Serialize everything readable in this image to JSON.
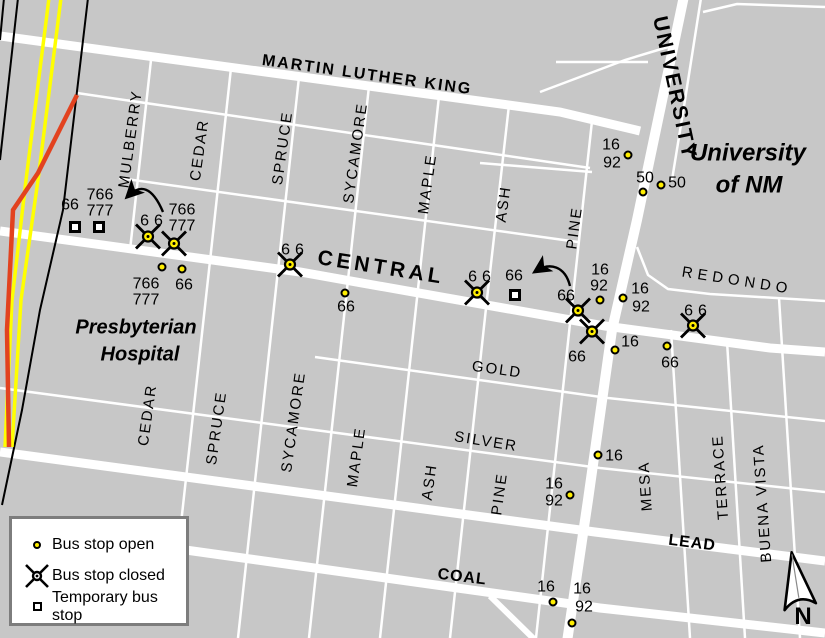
{
  "map": {
    "colors": {
      "background": "#c7c7c7",
      "street": "#ffffff",
      "railroad_yellow": "#ffff00",
      "route_highlight_red": "#e2421f",
      "stop_yellow": "#ffee00",
      "legend_border": "#7d7d7d"
    },
    "place_labels": [
      {
        "text": "Presbyterian",
        "x": 136,
        "y": 328,
        "cls": "place-sm"
      },
      {
        "text": "Hospital",
        "x": 140,
        "y": 355,
        "cls": "place-sm"
      },
      {
        "text": "University",
        "x": 748,
        "y": 153,
        "cls": "place-lg"
      },
      {
        "text": "of NM",
        "x": 749,
        "y": 185,
        "cls": "place-lg"
      }
    ],
    "street_labels": [
      {
        "text": "MARTIN LUTHER KING",
        "x": 367,
        "y": 76,
        "rot": 8,
        "cls": "s-mlk"
      },
      {
        "text": "CENTRAL",
        "x": 381,
        "y": 268,
        "rot": 9,
        "cls": "s-central"
      },
      {
        "text": "UNIVERSITY",
        "x": 674,
        "y": 88,
        "rot": 78,
        "cls": "s-univ"
      },
      {
        "text": "REDONDO",
        "x": 737,
        "y": 281,
        "rot": 9,
        "cls": "s-redondo"
      },
      {
        "text": "GOLD",
        "x": 497,
        "y": 370,
        "rot": 8,
        "cls": "s-minor"
      },
      {
        "text": "SILVER",
        "x": 486,
        "y": 442,
        "rot": 9,
        "cls": "s-minor"
      },
      {
        "text": "LEAD",
        "x": 692,
        "y": 544,
        "rot": 7,
        "cls": "s-bold"
      },
      {
        "text": "COAL",
        "x": 462,
        "y": 578,
        "rot": 7,
        "cls": "s-bold"
      },
      {
        "text": "MULBERRY",
        "x": 131,
        "y": 139,
        "rot": -82,
        "cls": "s-minor"
      },
      {
        "text": "CEDAR",
        "x": 200,
        "y": 150,
        "rot": -82,
        "cls": "s-minor"
      },
      {
        "text": "SPRUCE",
        "x": 283,
        "y": 148,
        "rot": -82,
        "cls": "s-minor"
      },
      {
        "text": "SYCAMORE",
        "x": 356,
        "y": 153,
        "rot": -82,
        "cls": "s-minor"
      },
      {
        "text": "MAPLE",
        "x": 428,
        "y": 184,
        "rot": -82,
        "cls": "s-minor"
      },
      {
        "text": "ASH",
        "x": 504,
        "y": 204,
        "rot": -82,
        "cls": "s-minor"
      },
      {
        "text": "PINE",
        "x": 575,
        "y": 228,
        "rot": -82,
        "cls": "s-minor"
      },
      {
        "text": "CEDAR",
        "x": 148,
        "y": 415,
        "rot": -82,
        "cls": "s-minor"
      },
      {
        "text": "SPRUCE",
        "x": 217,
        "y": 428,
        "rot": -82,
        "cls": "s-minor"
      },
      {
        "text": "SYCAMORE",
        "x": 294,
        "y": 422,
        "rot": -82,
        "cls": "s-minor"
      },
      {
        "text": "MAPLE",
        "x": 357,
        "y": 457,
        "rot": -82,
        "cls": "s-minor"
      },
      {
        "text": "ASH",
        "x": 430,
        "y": 482,
        "rot": -82,
        "cls": "s-minor"
      },
      {
        "text": "PINE",
        "x": 500,
        "y": 494,
        "rot": -82,
        "cls": "s-minor"
      },
      {
        "text": "MESA",
        "x": 646,
        "y": 486,
        "rot": -94,
        "cls": "s-minor"
      },
      {
        "text": "TERRACE",
        "x": 721,
        "y": 477,
        "rot": -94,
        "cls": "s-minor"
      },
      {
        "text": "BUENA VISTA",
        "x": 763,
        "y": 503,
        "rot": -94,
        "cls": "s-minor"
      }
    ],
    "stops": [
      {
        "type": "temporary",
        "x": 75,
        "y": 227,
        "routes": [
          {
            "t": "66",
            "x": 70,
            "y": 206
          }
        ]
      },
      {
        "type": "temporary",
        "x": 99,
        "y": 227,
        "routes": [
          {
            "t": "766",
            "x": 100,
            "y": 196
          },
          {
            "t": "777",
            "x": 100,
            "y": 212
          }
        ]
      },
      {
        "type": "closed",
        "x": 148,
        "y": 239,
        "routes": [
          {
            "t": "66",
            "x": 154,
            "y": 222,
            "sp": true
          }
        ]
      },
      {
        "type": "closed",
        "x": 174,
        "y": 246,
        "routes": [
          {
            "t": "766",
            "x": 182,
            "y": 211
          },
          {
            "t": "777",
            "x": 182,
            "y": 227
          }
        ]
      },
      {
        "type": "open",
        "x": 162,
        "y": 267,
        "routes": [
          {
            "t": "766",
            "x": 146,
            "y": 285
          },
          {
            "t": "777",
            "x": 146,
            "y": 301
          }
        ]
      },
      {
        "type": "open",
        "x": 182,
        "y": 269,
        "routes": [
          {
            "t": "66",
            "x": 184,
            "y": 286
          }
        ]
      },
      {
        "type": "closed",
        "x": 290,
        "y": 267,
        "routes": [
          {
            "t": "66",
            "x": 295,
            "y": 251,
            "sp": true
          }
        ]
      },
      {
        "type": "open",
        "x": 345,
        "y": 293,
        "routes": [
          {
            "t": "66",
            "x": 346,
            "y": 308
          }
        ]
      },
      {
        "type": "closed",
        "x": 477,
        "y": 295,
        "routes": [
          {
            "t": "66",
            "x": 482,
            "y": 278,
            "sp": true
          }
        ]
      },
      {
        "type": "temporary",
        "x": 515,
        "y": 295,
        "routes": [
          {
            "t": "66",
            "x": 514,
            "y": 277
          }
        ]
      },
      {
        "type": "closed",
        "x": 578,
        "y": 313,
        "routes": [
          {
            "t": "66",
            "x": 566,
            "y": 297
          }
        ]
      },
      {
        "type": "closed",
        "x": 592,
        "y": 334,
        "routes": [
          {
            "t": "66",
            "x": 577,
            "y": 358
          }
        ]
      },
      {
        "type": "open",
        "x": 600,
        "y": 300,
        "routes": [
          {
            "t": "16",
            "x": 600,
            "y": 271
          },
          {
            "t": "92",
            "x": 599,
            "y": 287
          }
        ]
      },
      {
        "type": "open",
        "x": 623,
        "y": 298,
        "routes": [
          {
            "t": "16",
            "x": 640,
            "y": 290
          },
          {
            "t": "92",
            "x": 641,
            "y": 308
          }
        ]
      },
      {
        "type": "open",
        "x": 615,
        "y": 350,
        "routes": [
          {
            "t": "16",
            "x": 630,
            "y": 343
          }
        ]
      },
      {
        "type": "open",
        "x": 667,
        "y": 346,
        "routes": [
          {
            "t": "66",
            "x": 670,
            "y": 364
          }
        ]
      },
      {
        "type": "closed",
        "x": 693,
        "y": 328,
        "routes": [
          {
            "t": "66",
            "x": 698,
            "y": 312,
            "sp": true
          }
        ]
      },
      {
        "type": "open",
        "x": 628,
        "y": 155,
        "routes": [
          {
            "t": "16",
            "x": 611,
            "y": 146
          },
          {
            "t": "92",
            "x": 612,
            "y": 164
          }
        ]
      },
      {
        "type": "open",
        "x": 643,
        "y": 192,
        "routes": [
          {
            "t": "50",
            "x": 645,
            "y": 179
          }
        ]
      },
      {
        "type": "open",
        "x": 661,
        "y": 185,
        "routes": [
          {
            "t": "50",
            "x": 677,
            "y": 184
          }
        ]
      },
      {
        "type": "open",
        "x": 598,
        "y": 455,
        "routes": [
          {
            "t": "16",
            "x": 614,
            "y": 457
          }
        ]
      },
      {
        "type": "open",
        "x": 570,
        "y": 495,
        "routes": [
          {
            "t": "16",
            "x": 554,
            "y": 485
          },
          {
            "t": "92",
            "x": 554,
            "y": 502
          }
        ]
      },
      {
        "type": "open",
        "x": 553,
        "y": 602,
        "routes": [
          {
            "t": "16",
            "x": 546,
            "y": 588
          }
        ]
      },
      {
        "type": "open",
        "x": 572,
        "y": 623,
        "routes": [
          {
            "t": "16",
            "x": 582,
            "y": 590
          },
          {
            "t": "92",
            "x": 584,
            "y": 608
          }
        ]
      }
    ],
    "legend": {
      "items": [
        {
          "symbol": "open",
          "label": "Bus stop open"
        },
        {
          "symbol": "closed",
          "label": "Bus stop closed"
        },
        {
          "symbol": "temporary",
          "label": "Temporary bus stop"
        }
      ]
    },
    "north_label": "N"
  }
}
